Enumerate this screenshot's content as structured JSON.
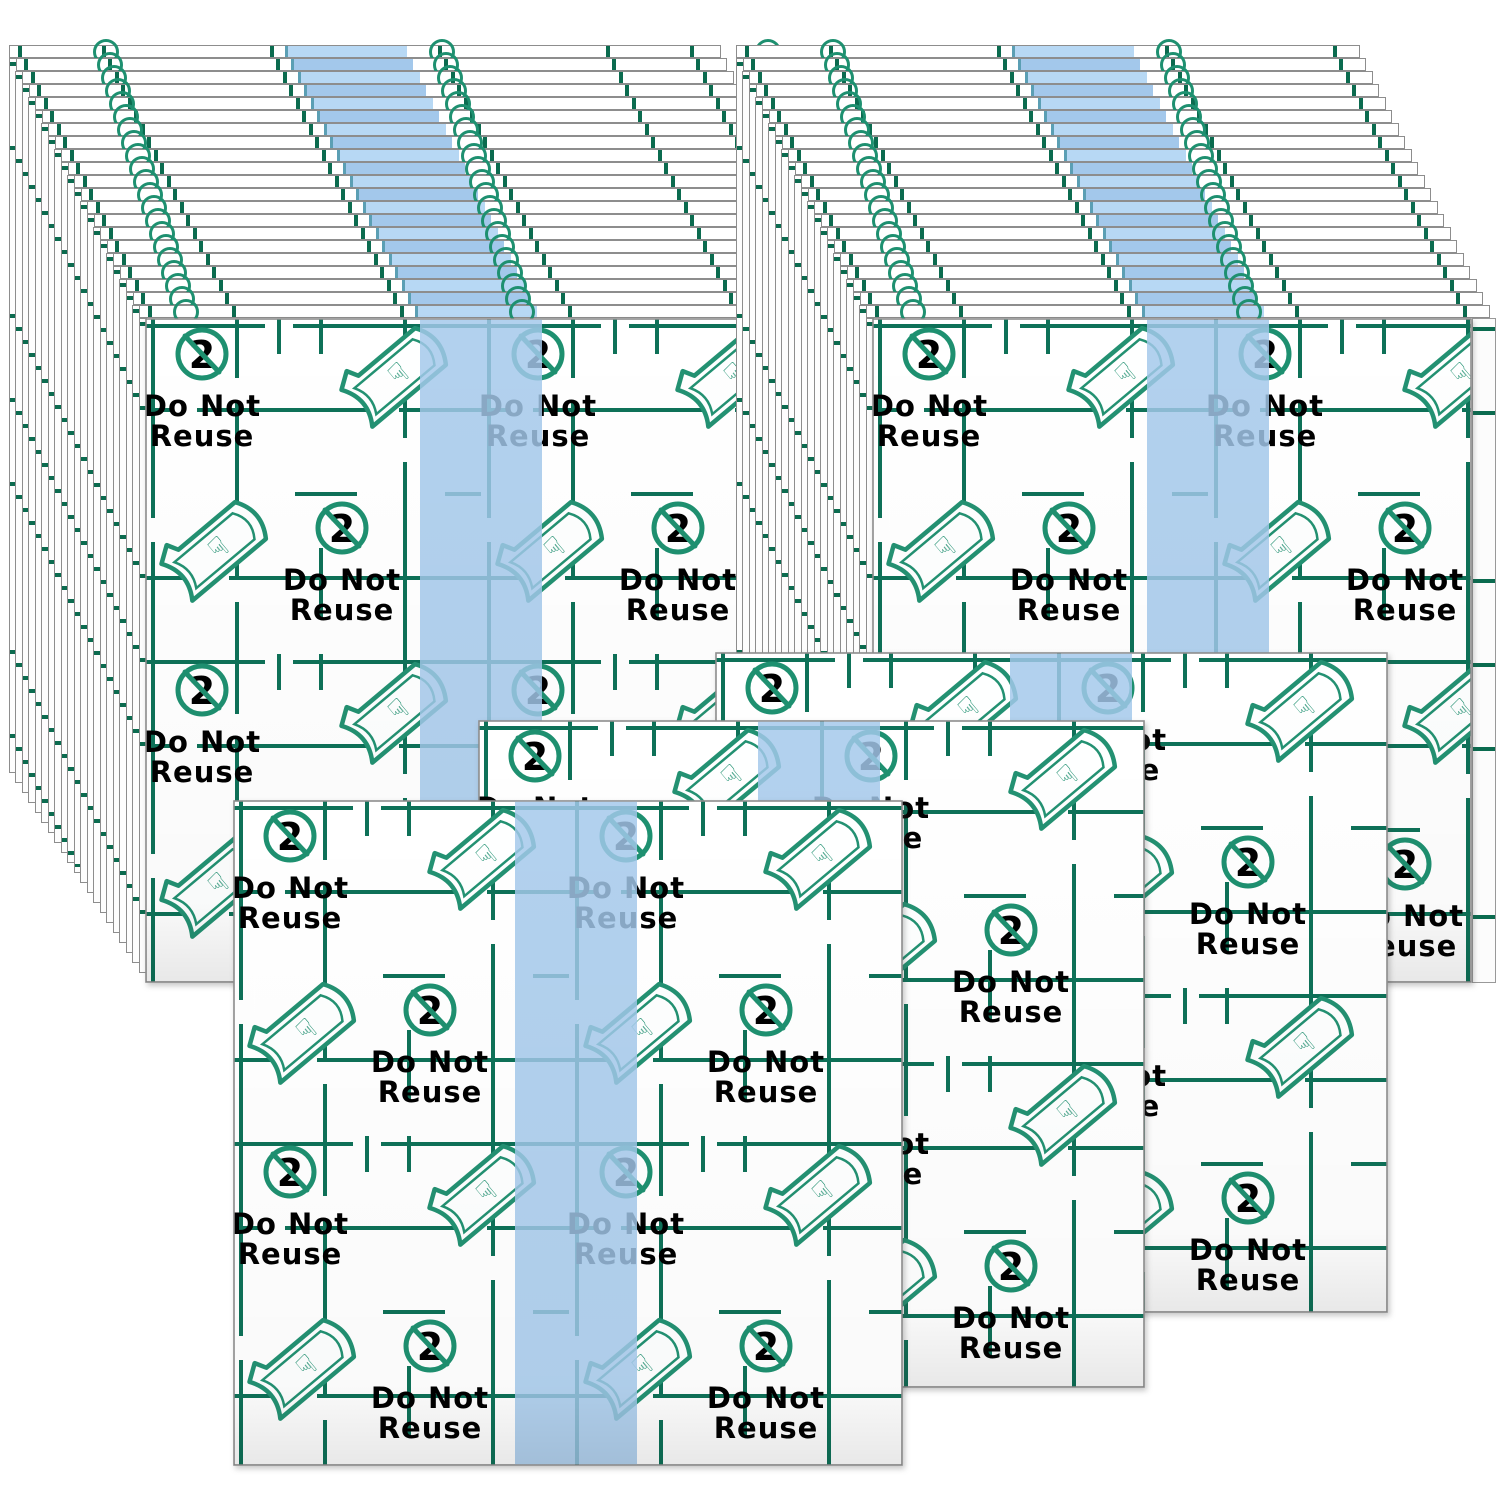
{
  "label": {
    "line1": "Do Not",
    "line2": "Reuse",
    "symbol": "2"
  },
  "colors": {
    "grid_green": "#0e7158",
    "tick_green": "#0b6b4f",
    "icon_green": "#1e9070",
    "text_green": "#2c8e72",
    "stripe_blue": "#a3c8eb",
    "stripe_blue_alt": "#b7d8f4",
    "stripe_edge_teal": "#5b9fb4",
    "edge_gray": "#8d8d8d",
    "sheet_white": "#ffffff"
  },
  "scene": {
    "stripe_w": 122,
    "stacks": [
      {
        "name": "stack-left",
        "face": {
          "x": 145,
          "y": 318,
          "w": 712,
          "h": 665
        },
        "strip_count": 21,
        "step_x": 6.5,
        "step_y": 13,
        "bottom_step": 10,
        "stripe_rel": 275,
        "chains_rel": [
          44,
          380,
          706
        ],
        "side_edge_w": 0
      },
      {
        "name": "stack-right",
        "face": {
          "x": 872,
          "y": 318,
          "w": 600,
          "h": 665
        },
        "strip_count": 21,
        "step_x": 6.5,
        "step_y": 13,
        "bottom_step": 10,
        "stripe_rel": 275,
        "chains_rel": [
          44,
          380
        ],
        "side_edge_w": 24
      }
    ],
    "sheets": [
      {
        "name": "sheet-back-right",
        "x": 715,
        "y": 652,
        "w": 673,
        "h": 661,
        "stripe_rel": 295
      },
      {
        "name": "sheet-middle",
        "x": 478,
        "y": 720,
        "w": 667,
        "h": 668,
        "stripe_rel": 280
      },
      {
        "name": "sheet-front-left",
        "x": 233,
        "y": 800,
        "w": 670,
        "h": 666,
        "stripe_rel": 282
      }
    ]
  }
}
